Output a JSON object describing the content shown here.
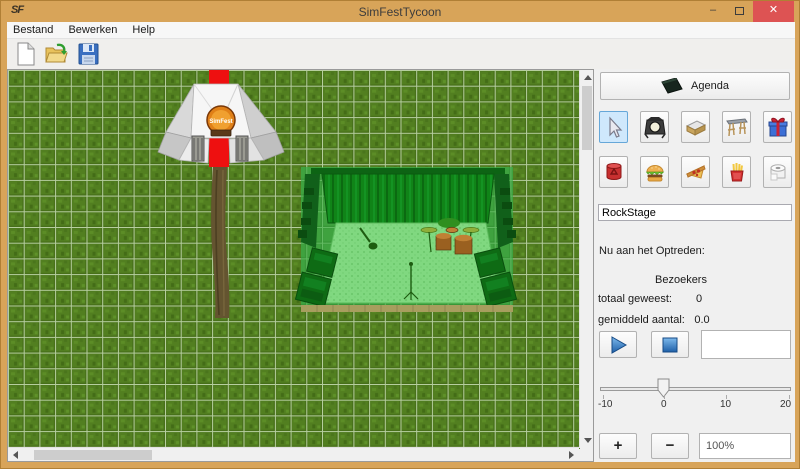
{
  "window": {
    "title": "SimFestTycoon",
    "icon_text": "SF",
    "minimize_glyph": "–",
    "close_glyph": "✕"
  },
  "menu_bar": {
    "items": [
      {
        "label": "Bestand"
      },
      {
        "label": "Bewerken"
      },
      {
        "label": "Help"
      }
    ]
  },
  "toolbar": {
    "buttons": [
      {
        "name": "new-file",
        "icon": "blank-page-icon"
      },
      {
        "name": "open-file",
        "icon": "open-folder-icon"
      },
      {
        "name": "save-file",
        "icon": "floppy-disk-icon"
      }
    ]
  },
  "canvas": {
    "tent_logo_text": "SimFest",
    "objects": [
      "entrance-tent",
      "red-carpet",
      "dirt-path",
      "stage-preview-green-tinted"
    ]
  },
  "sidebar": {
    "agenda_label": "Agenda",
    "agenda_icon": "notebook-icon",
    "tools_row1": [
      {
        "name": "select",
        "icon": "cursor-icon",
        "selected": true
      },
      {
        "name": "spotlight",
        "icon": "spotlight-icon",
        "selected": false
      },
      {
        "name": "stage",
        "icon": "stage-platform-icon",
        "selected": false
      },
      {
        "name": "entrance-gate",
        "icon": "gate-icon",
        "selected": false
      },
      {
        "name": "gift-shop",
        "icon": "gift-icon",
        "selected": false
      }
    ],
    "tools_row2": [
      {
        "name": "trash-bin",
        "icon": "trash-can-icon",
        "selected": false
      },
      {
        "name": "burger-stand",
        "icon": "burger-icon",
        "selected": false
      },
      {
        "name": "pizza-stand",
        "icon": "pizza-icon",
        "selected": false
      },
      {
        "name": "fries-stand",
        "icon": "fries-icon",
        "selected": false
      },
      {
        "name": "toilet",
        "icon": "toilet-paper-icon",
        "selected": false
      }
    ],
    "stage_name_input": "RockStage",
    "now_performing_label": "Nu aan het Optreden:",
    "visitors_header": "Bezoekers",
    "stats": [
      {
        "label": "totaal geweest:",
        "value": "0"
      },
      {
        "label": "gemiddeld aantal:",
        "value": "0.0"
      }
    ],
    "slider": {
      "min": -10,
      "max": 20,
      "value": 0,
      "tick_labels": [
        "-10",
        "0",
        "10",
        "20"
      ]
    },
    "zoom": {
      "in_label": "+",
      "out_label": "−",
      "level": "100%"
    }
  },
  "colors": {
    "titlebar": "#d8a459",
    "close_button": "#dd5353",
    "selected_tool_bg": "#cfe8fc",
    "grass_green": "#527f20",
    "grid_line": "#b7cfa0",
    "carpet_red": "#ee1010",
    "path_brown": "#645430",
    "stage_tint_green": "#3fa23f"
  }
}
